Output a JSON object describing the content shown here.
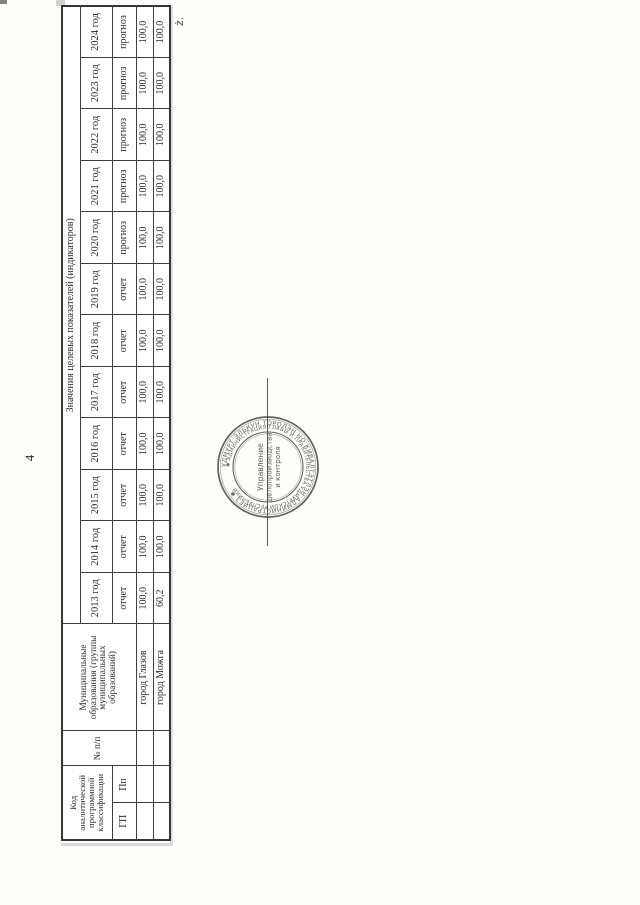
{
  "page": {
    "number": "4",
    "margin_mark": "ż."
  },
  "table": {
    "code_header": "Код аналитической программной классификации",
    "code_columns": [
      "ГП",
      "Пп"
    ],
    "num_header": "№ п/п",
    "municipality_header": "Муниципальные образования (группы муниципальных образований)",
    "values_header": "Значения целевых показателей (индикаторов)",
    "years": [
      {
        "year": "2013 год",
        "type": "отчет"
      },
      {
        "year": "2014 год",
        "type": "отчет"
      },
      {
        "year": "2015 год",
        "type": "отчет"
      },
      {
        "year": "2016 год",
        "type": "отчет"
      },
      {
        "year": "2017 год",
        "type": "отчет"
      },
      {
        "year": "2018 год",
        "type": "отчет"
      },
      {
        "year": "2019 год",
        "type": "отчет"
      },
      {
        "year": "2020 год",
        "type": "прогноз"
      },
      {
        "year": "2021 год",
        "type": "прогноз"
      },
      {
        "year": "2022 год",
        "type": "прогноз"
      },
      {
        "year": "2023 год",
        "type": "прогноз"
      },
      {
        "year": "2024 год",
        "type": "прогноз"
      }
    ],
    "rows": [
      {
        "gp": "",
        "pp": "",
        "num": "",
        "name": "город Глазов",
        "values": [
          "100,0",
          "100,0",
          "100,0",
          "100,0",
          "100,0",
          "100,0",
          "100,0",
          "100,0",
          "100,0",
          "100,0",
          "100,0",
          "100,0"
        ]
      },
      {
        "gp": "",
        "pp": "",
        "num": "",
        "name": "город Можга",
        "values": [
          "60,2",
          "100,0",
          "100,0",
          "100,0",
          "100,0",
          "100,0",
          "100,0",
          "100,0",
          "100,0",
          "100,0",
          "100,0",
          "100,0"
        ]
      }
    ]
  },
  "stamp": {
    "outer_ring": "УДМУРТ ЭЛЬКУН ТОРОЛЭН НО КИВАЛТЭТЛЭН АДМИНИСТРАЦИЕЗ ✱ ",
    "inner_ring": "✱ АДМИНИСТРАЦИЯ ГЛАВЫ И ПРАВИТЕЛЬСТВА УДМУРТСКОЙ РЕСПУБЛИКИ",
    "center_lines": [
      "Управление",
      "делопроизводства",
      "и контроля"
    ]
  },
  "colors": {
    "ink": "#2e2e2e",
    "table_line": "#3e3e3e",
    "stamp_ink": "#4d4d4d"
  }
}
